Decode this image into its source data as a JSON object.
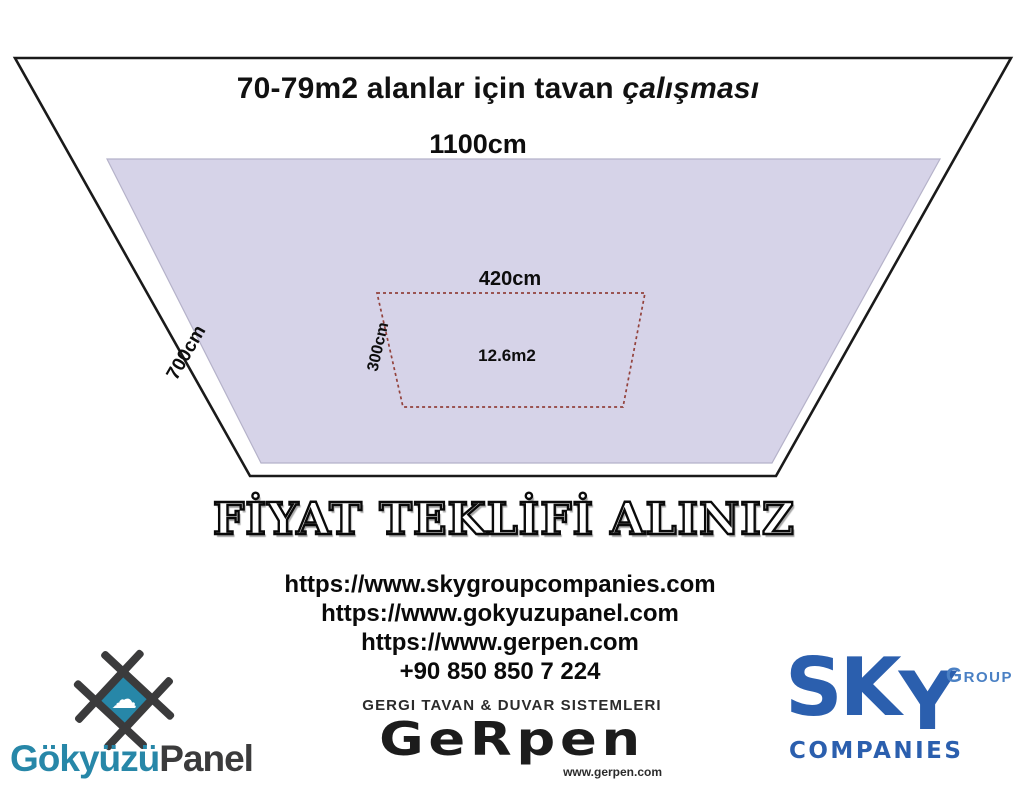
{
  "poster": {
    "title": {
      "main": "70-79m2 alanlar için tavan ",
      "emphasis": "çalışması"
    },
    "diagram": {
      "outer_width_label": "1100cm",
      "outer_side_label": "700cm",
      "inner_width_label": "420cm",
      "inner_side_label": "300cm",
      "inner_area_label": "12.6m2"
    },
    "cta": "FİYAT TEKLİFİ ALINIZ",
    "contact": {
      "links": [
        "https://www.skygroupcompanies.com",
        "https://www.gokyuzupanel.com",
        "https://www.gerpen.com"
      ],
      "phone": "+90 850 850 7 224"
    },
    "logos": {
      "gokyuzupanel": {
        "name_primary": "Gökyüzü",
        "name_secondary": "Panel",
        "cloud_glyph": "☁"
      },
      "gerpen": {
        "tagline": "GERGI TAVAN & DUVAR SISTEMLERI",
        "wordmark": "GeRpen",
        "website": "www.gerpen.com"
      },
      "sky": {
        "letters": [
          "S",
          "K",
          "Y"
        ],
        "group": "GROUP",
        "companies": "COMPANIES"
      }
    },
    "colors": {
      "ceiling_fill": "#d6d3e8",
      "ceiling_edge": "#b5b2c9",
      "outline": "#1a1a1a",
      "dashed_line": "#93423c",
      "teal": "#2787a8",
      "dark_gray": "#3b3b3c",
      "sky_blue": "#2b5fae",
      "group_blue": "#4a80c4"
    }
  }
}
